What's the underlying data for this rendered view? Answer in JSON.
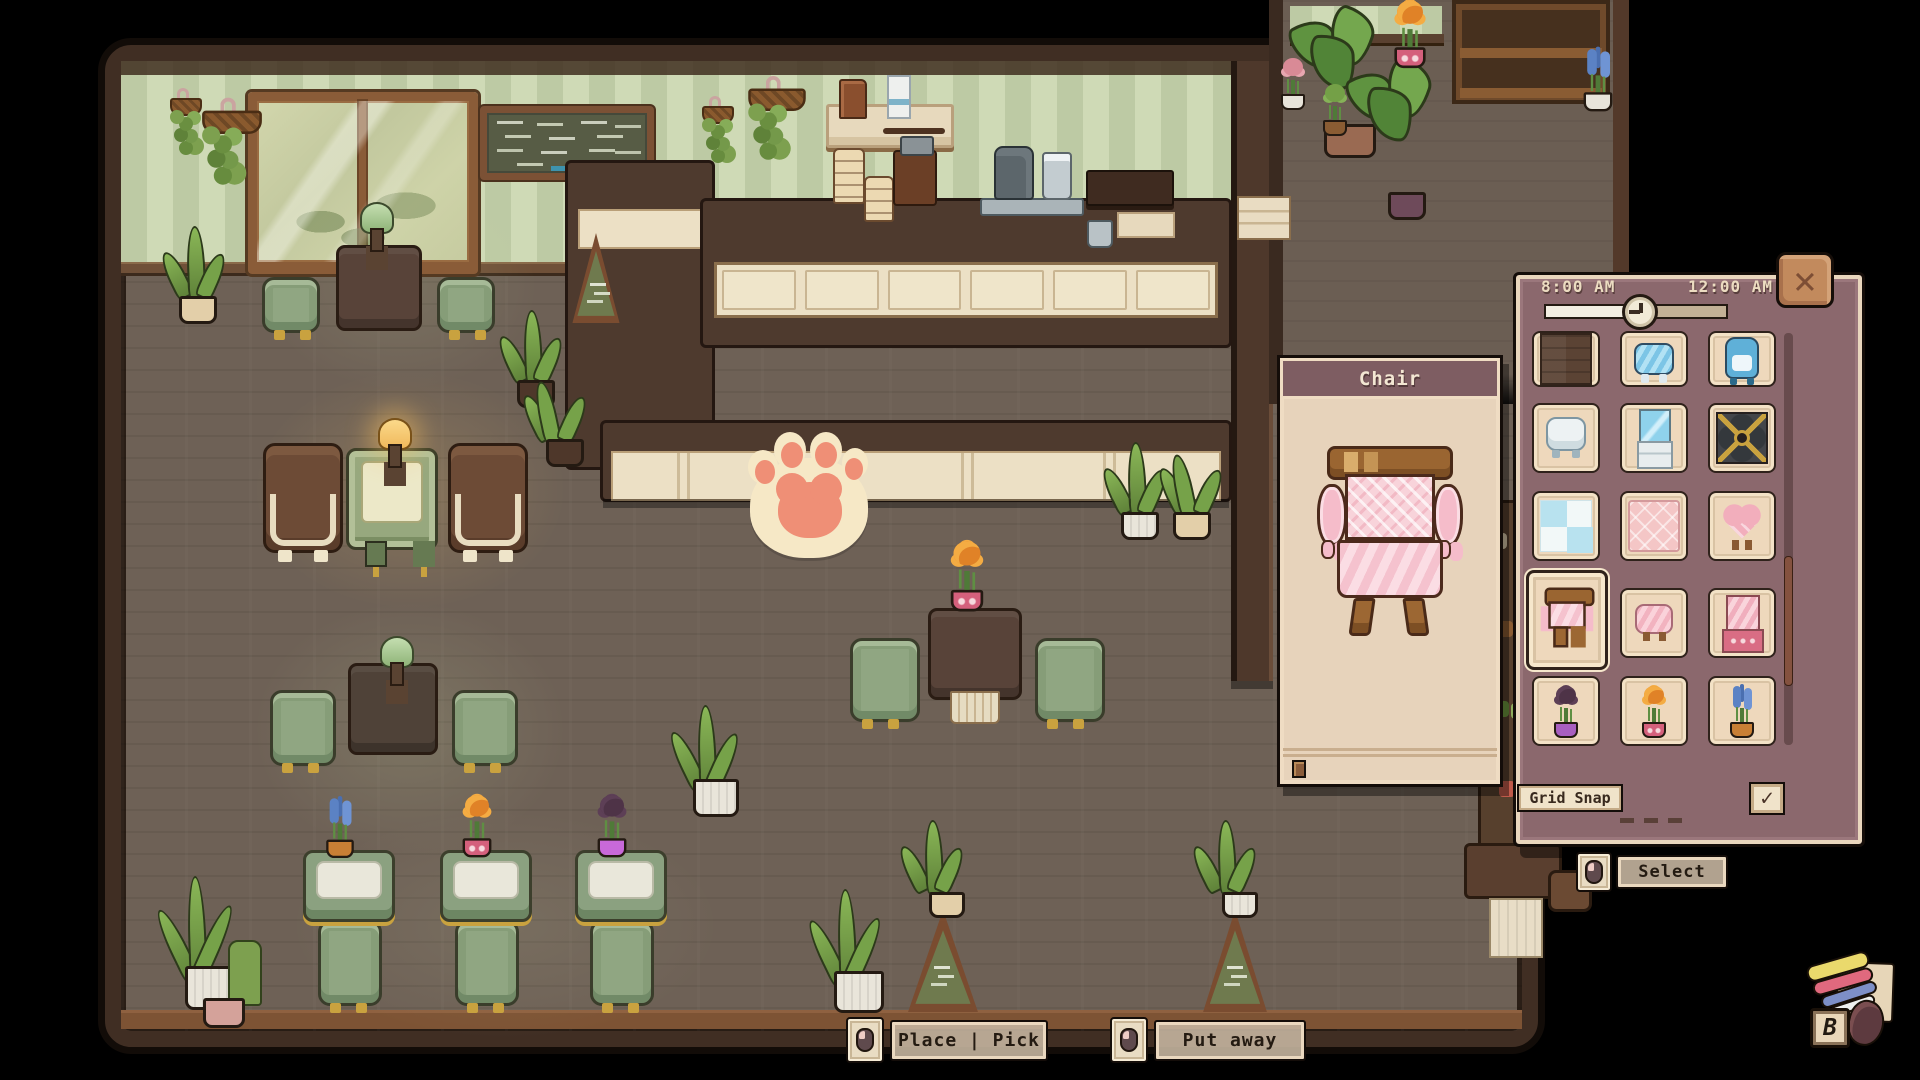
{
  "hud": {
    "time": {
      "start_label": "8:00 AM",
      "end_label": "12:00 AM",
      "progress_percent": 45
    },
    "close_glyph": "✕",
    "decorate_key_hint": "B"
  },
  "preview_panel": {
    "title": "Chair"
  },
  "catalog_panel": {
    "items": [
      "wood-floor-tile",
      "blue-striped-chair",
      "blue-penguin-chair",
      "white-rounded-chair",
      "blue-glass-vanity",
      "dark-petal-rug",
      "blue-checker-tile",
      "pink-diamond-rug",
      "pink-heart-chair",
      "pink-frilly-armchair",
      "pink-cushion-chair",
      "pink-striped-vanity",
      "purple-flower-pot",
      "orange-flower-pot",
      "blue-flower-pot"
    ],
    "selected_item": "pink-frilly-armchair",
    "selected_index": 9,
    "grid_snap": {
      "label": "Grid Snap",
      "checked": true,
      "check_glyph": "✓"
    }
  },
  "buttons": {
    "select_label": "Select",
    "place_pick_label": "Place | Pick",
    "put_away_label": "Put away"
  },
  "colors": {
    "panel_mauve": "#8b686d",
    "panel_cream": "#eed8bc",
    "accent_pink": "#f5c2ce",
    "wall_green": "#c7d4ae",
    "floor_brown": "#6e6156",
    "frame_brown": "#402e23"
  }
}
